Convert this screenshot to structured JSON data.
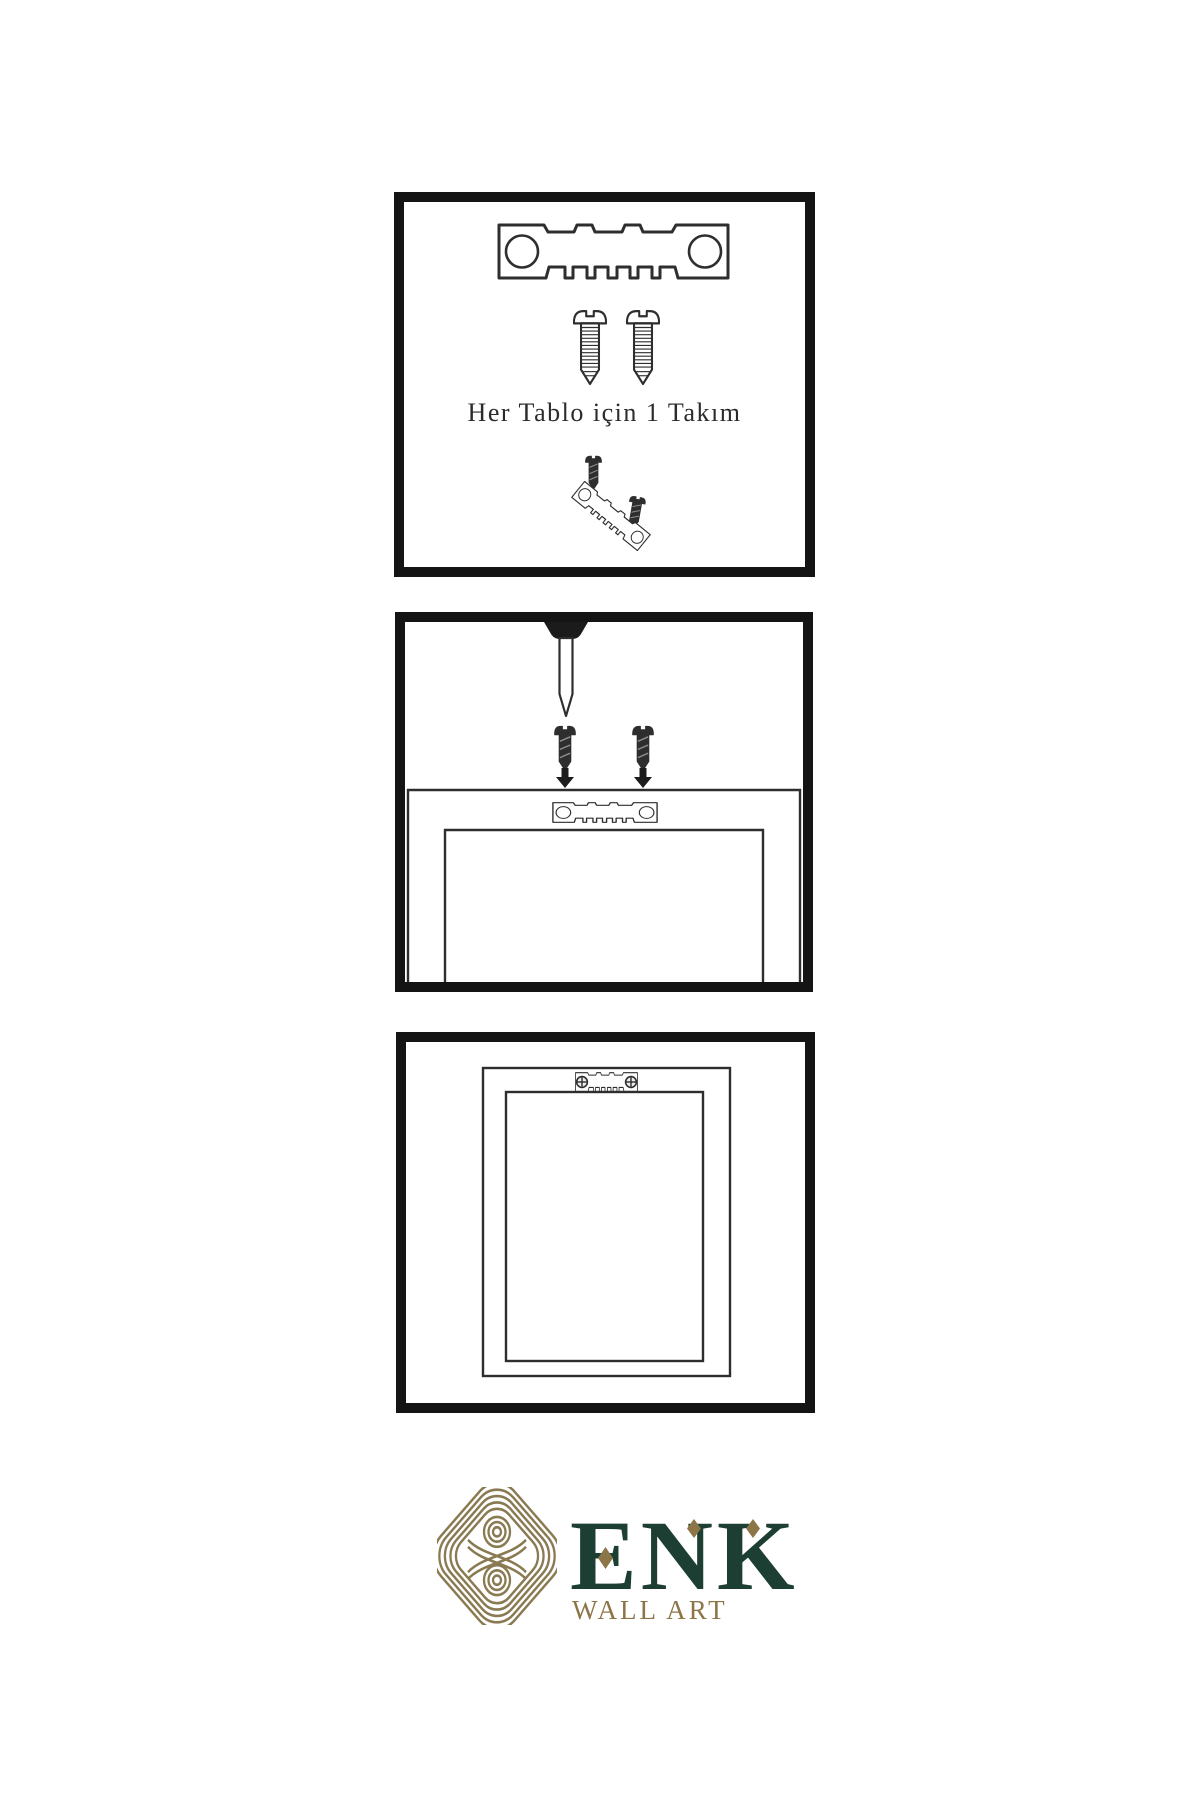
{
  "panels": [
    {
      "name": "hardware-kit",
      "caption": "Her Tablo için 1 Takım",
      "icons": [
        "sawtooth-hanger-plate-icon",
        "screw-icon",
        "screw-icon",
        "hanger-assembly-icon"
      ]
    },
    {
      "name": "install-hanger",
      "caption": "",
      "icons": [
        "nail-icon",
        "dark-screw-icon",
        "dark-screw-icon",
        "arrow-down-icon",
        "arrow-down-icon",
        "frame-back-icon",
        "sawtooth-hanger-plate-icon"
      ]
    },
    {
      "name": "hang-frame",
      "caption": "",
      "icons": [
        "frame-back-icon",
        "mounted-hanger-icon"
      ]
    }
  ],
  "brand": {
    "name": "ENK",
    "tagline": "WALL ART"
  },
  "colors": {
    "background": "#ffffff",
    "panel_border": "#141414",
    "line_art": "#2e2e2e",
    "brand_green": "#1d3e32",
    "brand_gold": "#8c7547",
    "knot_gold": "#8a7a52"
  }
}
